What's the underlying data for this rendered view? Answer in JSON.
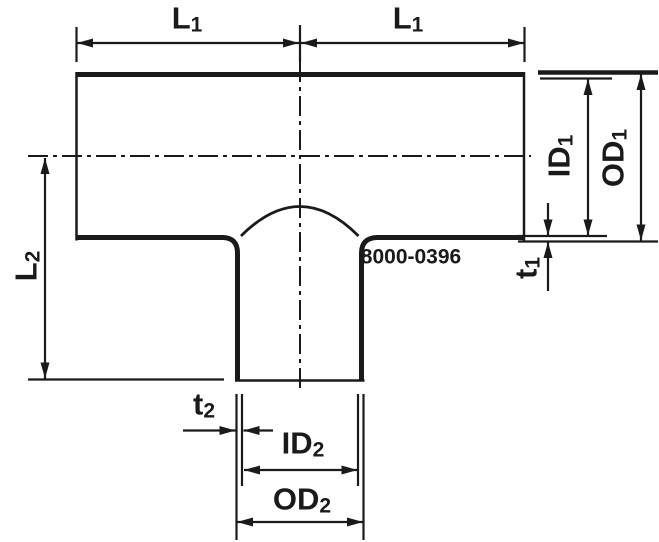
{
  "part_number": "8000-0396",
  "labels": {
    "l1_left": {
      "base": "L",
      "sub": "1"
    },
    "l1_right": {
      "base": "L",
      "sub": "1"
    },
    "id1": {
      "base": "ID",
      "sub": "1"
    },
    "od1": {
      "base": "OD",
      "sub": "1"
    },
    "t1": {
      "base": "t",
      "sub": "1"
    },
    "l2": {
      "base": "L",
      "sub": "2"
    },
    "t2": {
      "base": "t",
      "sub": "2"
    },
    "id2": {
      "base": "ID",
      "sub": "2"
    },
    "od2": {
      "base": "OD",
      "sub": "2"
    }
  },
  "colors": {
    "line": "#1a1a1a",
    "background": "#ffffff"
  }
}
